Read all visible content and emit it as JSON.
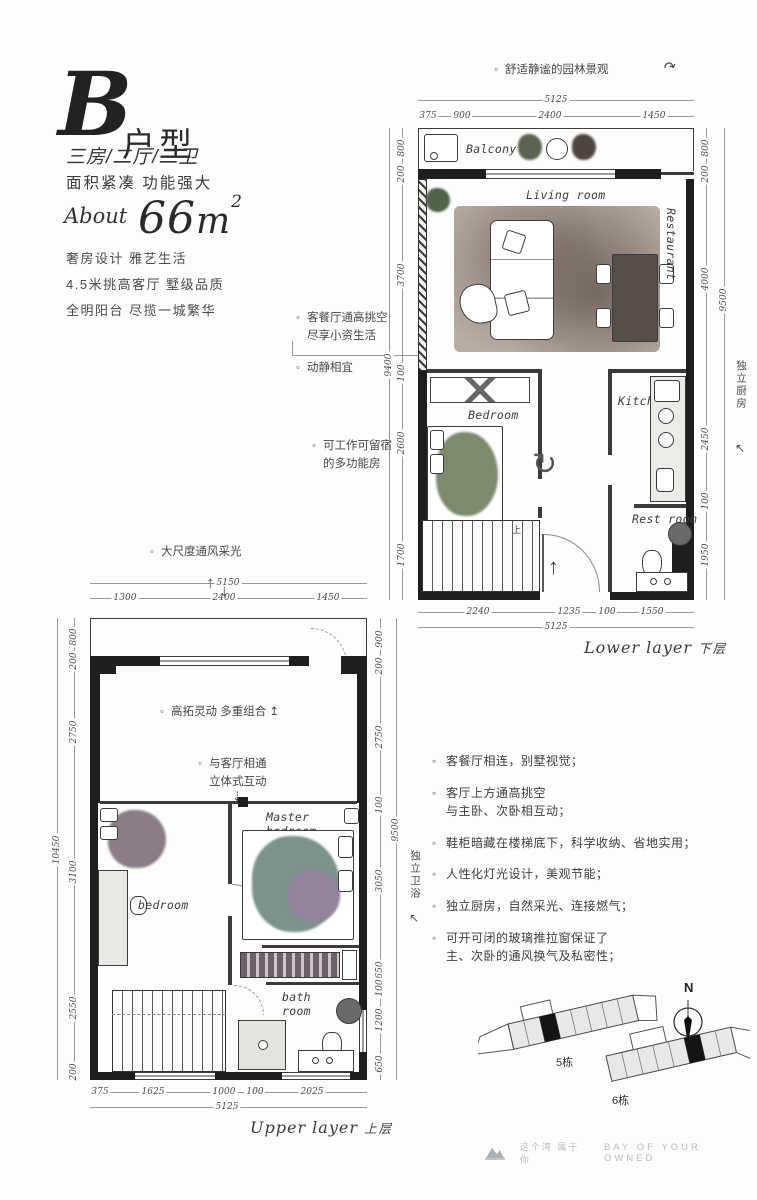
{
  "title": {
    "letter": "B",
    "type_label": "户型",
    "spec": "三房/二厅/二卫",
    "tagline": "面积紧凑 功能强大",
    "about": "About",
    "area": "66",
    "unit": "m",
    "sup": "2",
    "desc": "奢房设计 雅艺生活\n4.5米挑高客厅 墅级品质\n全明阳台 尽揽一城繁华"
  },
  "lower": {
    "garden_note": "舒适静谧的园林景观",
    "top_total": "5125",
    "top_dims": [
      "375",
      "900",
      "2400",
      "1450"
    ],
    "left_dims": [
      "800",
      "200",
      "3700",
      "100",
      "2600",
      "1700"
    ],
    "left_total": "9400",
    "right_dims": [
      "800",
      "200",
      "4000",
      "2450",
      "100",
      "1950"
    ],
    "right_total": "9500",
    "right_note": "独立厨房",
    "bottom_dims": [
      "2240",
      "1235",
      "100",
      "1550"
    ],
    "bottom_total": "5125",
    "caption_en": "Lower layer",
    "caption_cn": "下层",
    "rooms": {
      "balcony": "Balcony",
      "living": "Living room",
      "restaurant": "Restaurant",
      "bedroom": "Bedroom",
      "kitchen": "Kitchen",
      "restroom": "Rest room"
    },
    "stairs_up": "上"
  },
  "mid_notes": {
    "n1": "客餐厅通高挑空\n尽享小资生活",
    "n2": "动静相宜",
    "n3": "可工作可留宿\n的多功能房"
  },
  "upper": {
    "light_note": "大尺度通风采光",
    "top_total": "5150",
    "top_dims": [
      "1300",
      "2400",
      "1450"
    ],
    "left_dims": [
      "800",
      "200",
      "2750",
      "3100",
      "2550",
      "200"
    ],
    "left_total": "10450",
    "right_dims": [
      "900",
      "200",
      "2750",
      "100",
      "3050",
      "650",
      "100",
      "1200",
      "650"
    ],
    "right_total": "9500",
    "right_note": "独立卫浴",
    "bottom_dims": [
      "375",
      "1625",
      "1000",
      "100",
      "2025"
    ],
    "bottom_total": "5125",
    "caption_en": "Upper layer",
    "caption_cn": "上层",
    "void_note1": "高拓灵动  多重组合",
    "void_note2": "与客厅相通\n立体式互动",
    "rooms": {
      "master": "Master\nbedroom",
      "bedroom": "bedroom",
      "bath": "bath\nroom"
    }
  },
  "features": {
    "items": [
      "客餐厅相连，别墅视觉；",
      "客厅上方通高挑空\n与主卧、次卧相互动；",
      "鞋柜暗藏在楼梯底下，科学收纳、省地实用；",
      "人性化灯光设计，美观节能；",
      "独立厨房，自然采光、连接燃气；",
      "可开可闭的玻璃推拉窗保证了\n主、次卧的通风换气及私密性；"
    ]
  },
  "sitemap": {
    "b5": "5栋",
    "b6": "6栋",
    "north": "N"
  },
  "footer": {
    "cn": "这个湾 属于你",
    "en": "BAY OF YOUR OWNED"
  },
  "icons": {
    "rotate": "↻",
    "entry_arrow": "↑",
    "vent_up": "↑",
    "vent_down": "↓",
    "curve": "↷",
    "corner": "↖",
    "lift": "↥",
    "drop": "⇣"
  }
}
